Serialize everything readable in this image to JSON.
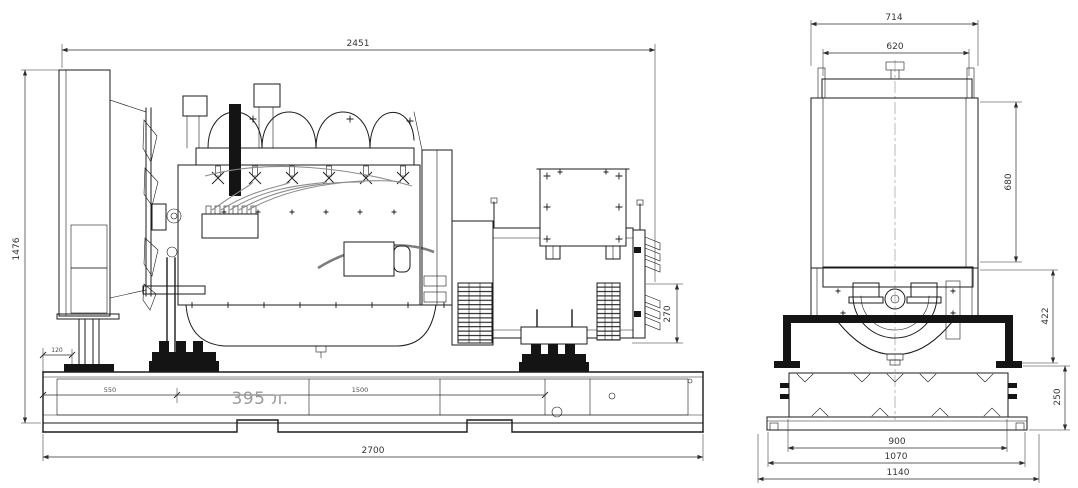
{
  "drawing": {
    "background": "#ffffff",
    "ink_color": "#1b1b1b",
    "tank_label": {
      "text": "395 л.",
      "color": "#9b9b9b"
    },
    "side_view_dims": {
      "overall_length": "2451",
      "overall_height": "1476",
      "base_length": "2700",
      "rear_mount_height": "270",
      "tank_segment_1": "550",
      "tank_segment_2": "1500",
      "front_margin": "120"
    },
    "front_view_dims": {
      "shroud_width": "714",
      "core_width": "620",
      "radiator_height": "680",
      "mount_height": "422",
      "tank_height": "250",
      "tank_width": "900",
      "skid_width": "1070",
      "overall_width": "1140"
    }
  }
}
